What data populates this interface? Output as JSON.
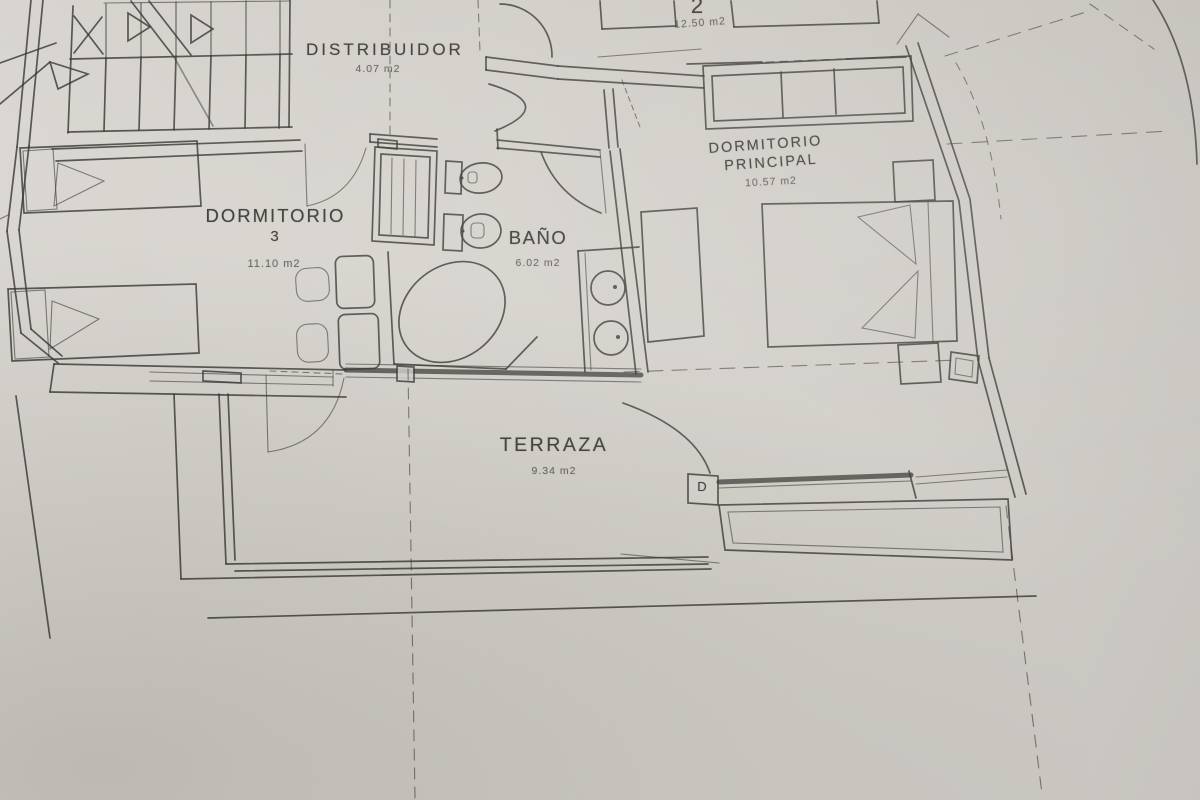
{
  "colors": {
    "paper": "#d7d4ce",
    "ink": "#3a3936"
  },
  "rooms": {
    "room2": {
      "label": "2",
      "area": "12.50 m2"
    },
    "distribuidor": {
      "label": "DISTRIBUIDOR",
      "area": "4.07 m2"
    },
    "dormitorio3": {
      "label": "DORMITORIO",
      "number": "3",
      "area": "11.10 m2"
    },
    "bano": {
      "label": "BAÑO",
      "area": "6.02 m2"
    },
    "dormitorio_principal": {
      "label_line1": "DORMITORIO",
      "label_line2": "PRINCIPAL",
      "area": "10.57 m2"
    },
    "terraza": {
      "label": "TERRAZA",
      "area": "9.34 m2"
    }
  },
  "annotations": {
    "door_marker": "D"
  }
}
